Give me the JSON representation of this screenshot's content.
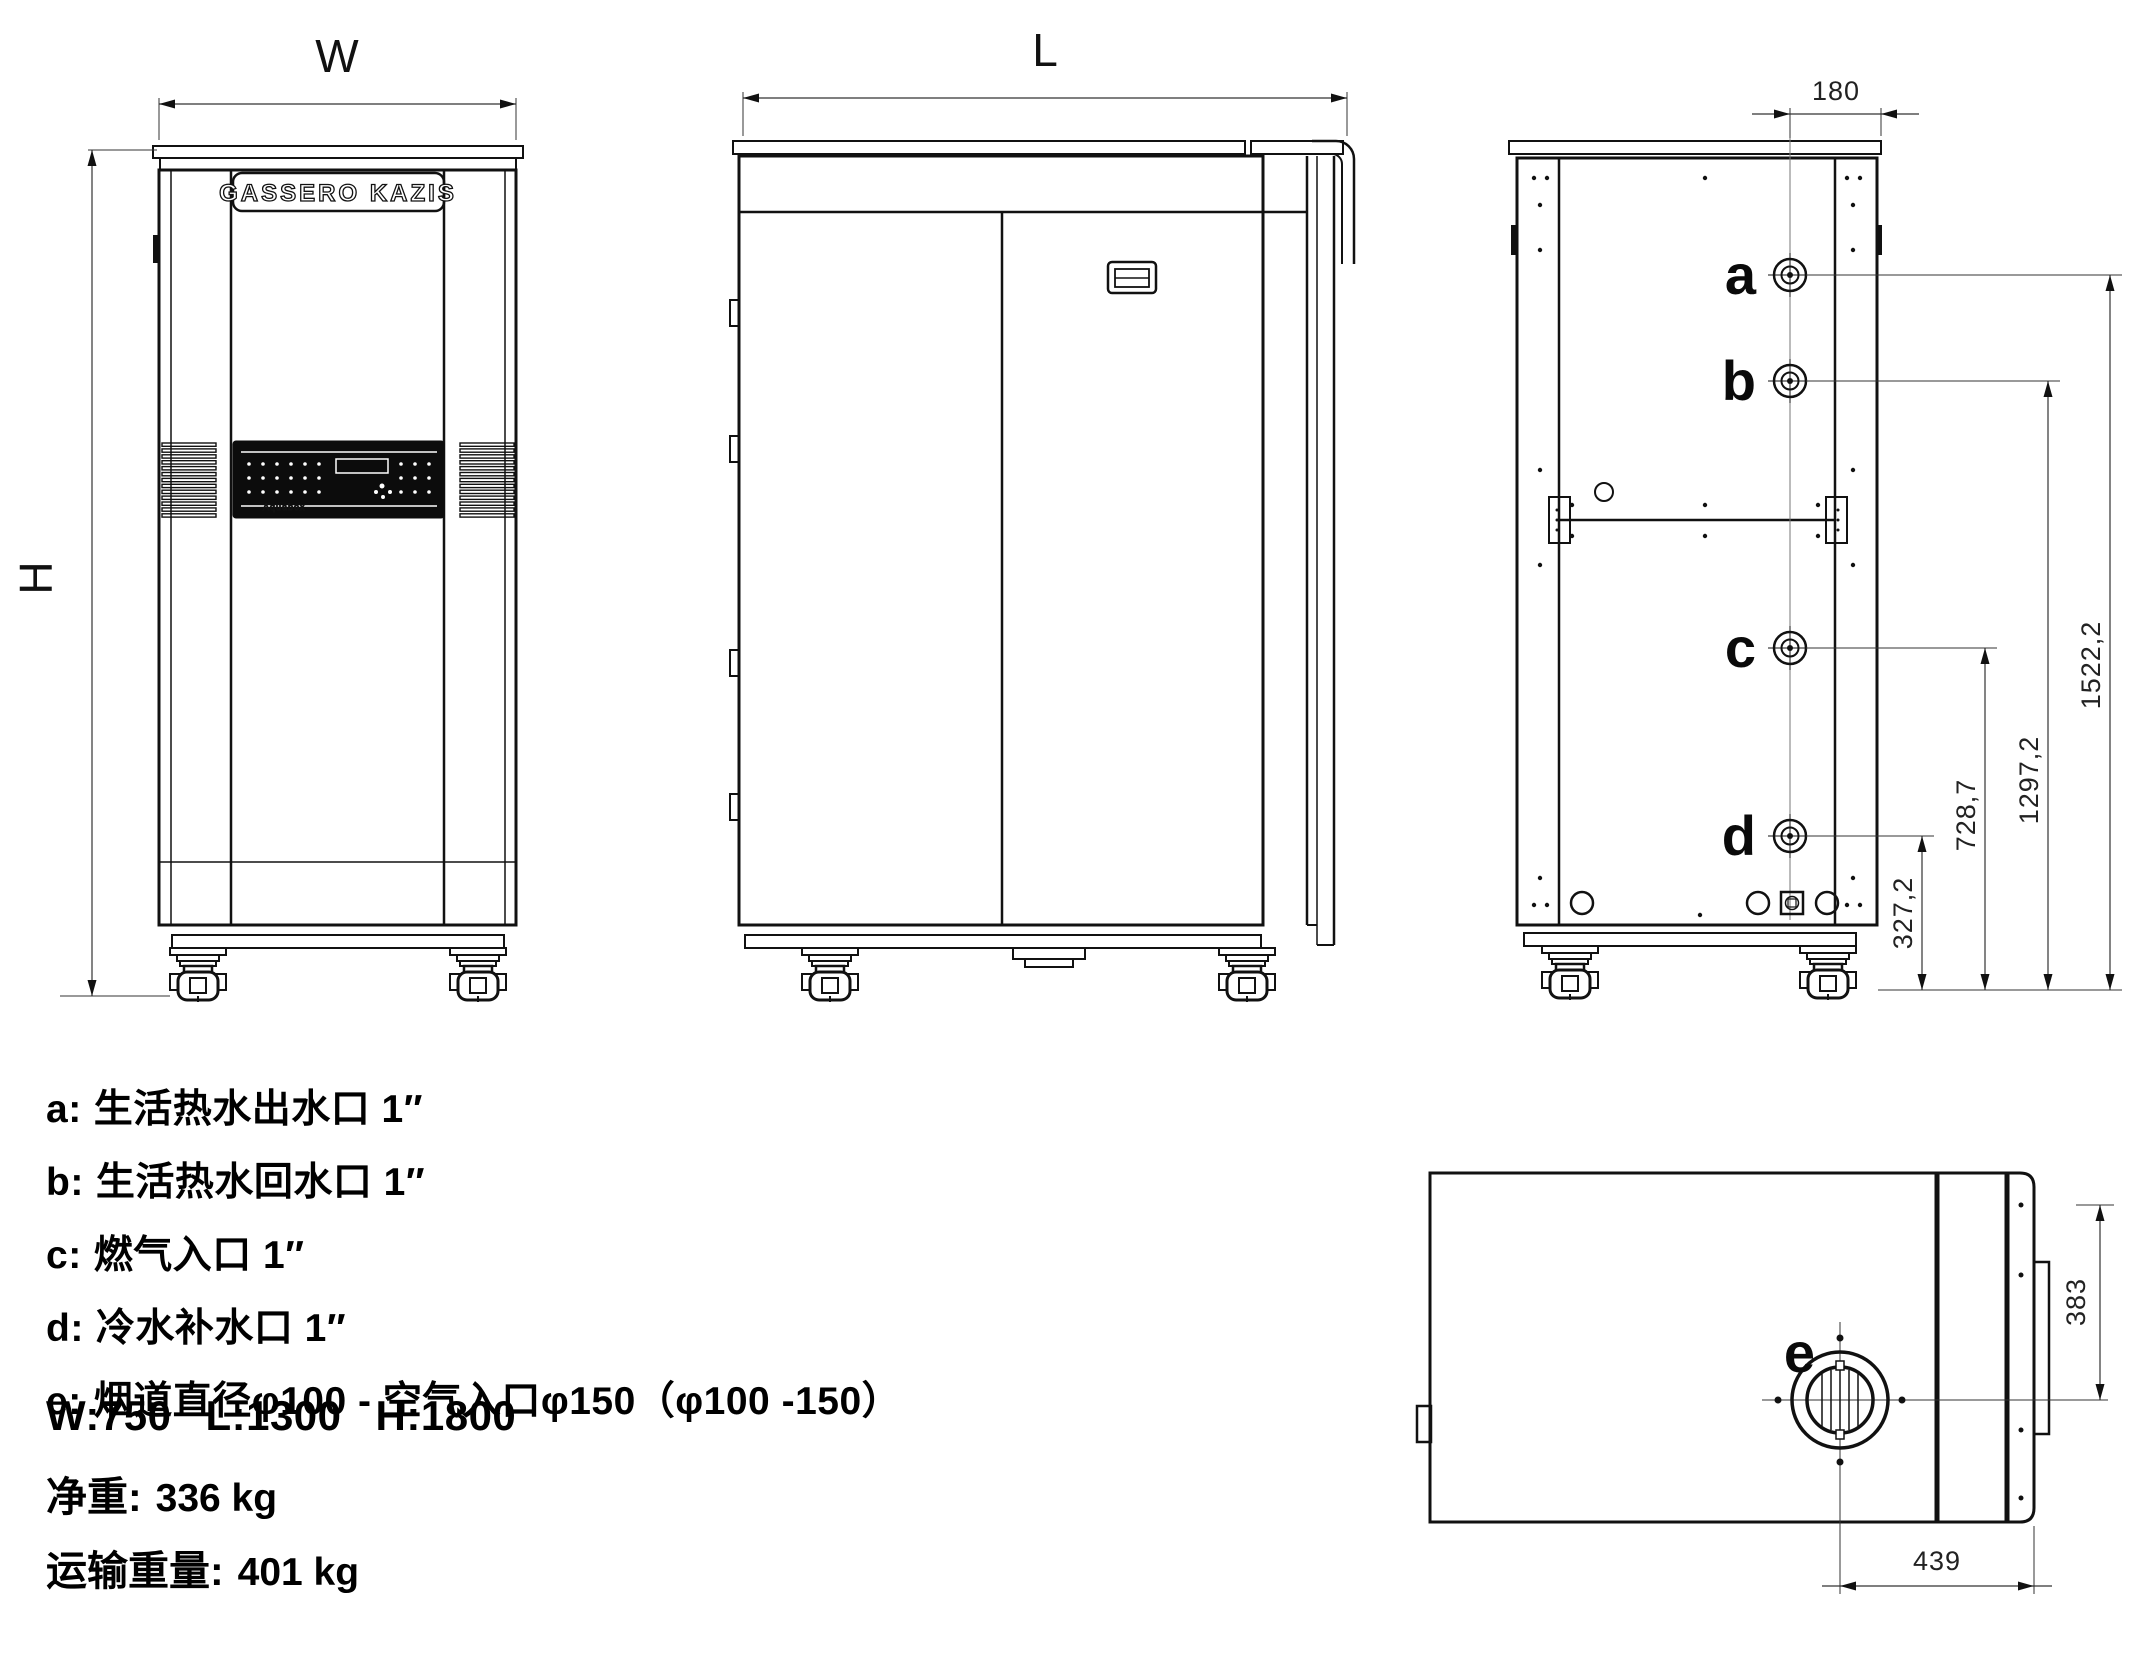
{
  "front_view": {
    "brand": "GASSERO KAZIS",
    "panel_text": "Aquabox",
    "width_label": "W",
    "height_label": "H"
  },
  "side_view": {
    "length_label": "L"
  },
  "rear_view": {
    "offset_dim": "180",
    "ports": [
      {
        "label": "a",
        "height": "1522,2"
      },
      {
        "label": "b",
        "height": "1297,2"
      },
      {
        "label": "c",
        "height": "728,7"
      },
      {
        "label": "d",
        "height": "327,2"
      }
    ]
  },
  "top_view": {
    "port_label": "e",
    "dim_right": "383",
    "dim_bottom": "439"
  },
  "legend": [
    {
      "key": "a:",
      "text": "生活热水出水口 1″"
    },
    {
      "key": "b:",
      "text": "生活热水回水口 1″"
    },
    {
      "key": "c:",
      "text": "燃气入口 1″"
    },
    {
      "key": "d:",
      "text": "冷水补水口 1″"
    },
    {
      "key": "e:",
      "text": "烟道直径φ100 - 空气入口φ150（φ100 -150）"
    }
  ],
  "specs": {
    "w": "W:750",
    "l": "L:1300",
    "h": "H:1800",
    "net_weight_label": "净重:",
    "net_weight": "336 kg",
    "ship_weight_label": "运输重量:",
    "ship_weight": "401 kg"
  }
}
